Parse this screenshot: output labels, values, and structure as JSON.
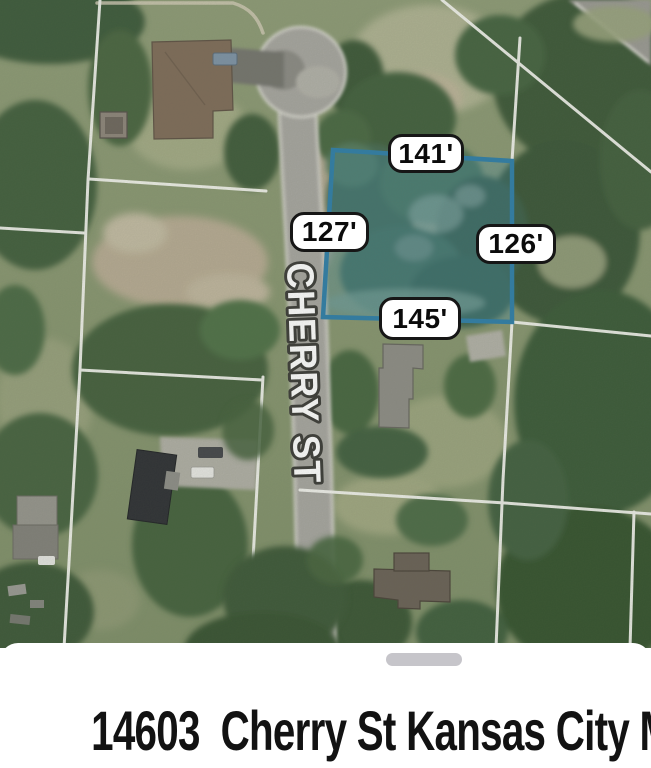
{
  "map": {
    "street_label": "CHERRY ST",
    "parcel": {
      "dim_top": "141'",
      "dim_left": "127'",
      "dim_right": "126'",
      "dim_bottom": "145'",
      "outline_color": "#2e7ea8"
    }
  },
  "sheet": {
    "address": "14603  Cherry St Kansas City MO"
  }
}
